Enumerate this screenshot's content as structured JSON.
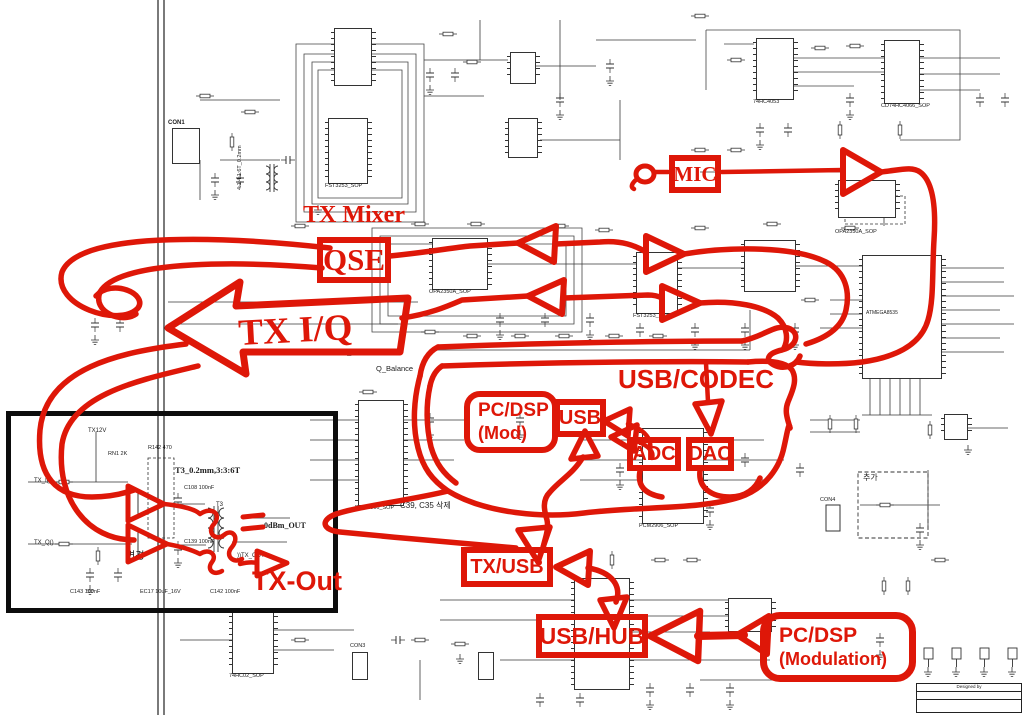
{
  "colors": {
    "annotation_red": "#de1708",
    "schematic_gray": "#333333",
    "box_black": "#0d0d0d"
  },
  "annotations": {
    "tx_mixer": "TX Mixer",
    "qse": "QSE",
    "tx_iq": "TX I/Q",
    "mic": "MIC",
    "usb_codec": "USB/CODEC",
    "pc_dsp_mod": {
      "line1": "PC/DSP",
      "line2": "(Mod)"
    },
    "usb": "USB",
    "adc": "ADC",
    "dac": "DAC",
    "tx_usb": "TX/USB",
    "usb_hub": "USB/HUB",
    "pc_dsp_modulation": {
      "line1": "PC/DSP",
      "line2": "(Modulation)"
    },
    "tx_out": "TX-Out"
  },
  "schematic": {
    "ic_labels": {
      "fst3253_top": "FST3253_SOP",
      "hc4053": "74HC4053",
      "hc4066": "CD74HC4066_SOP",
      "opa_left": "OPA2350A_SOP",
      "fst3253_mid": "FST3253_SOP",
      "opa_mic": "OPA2350A_SOP",
      "mcu": "ATMEGA8535",
      "pcm_left": "PCM2906_SOP",
      "pcm_right": "PCM2906_SOP",
      "hc02": "74HC02_SOP"
    },
    "texts": {
      "winding_note": "3:3:6T_0.2mm",
      "q_balance": "Q_Balance",
      "t3_note": "T3_0.2mm,3:3:6T",
      "dbm_out": "0dBm_OUT",
      "tx_out_net": "))TX_OUT",
      "tx12v": "TX12V",
      "tx_i": "TX_I()",
      "tx_q": "TX_Q()",
      "change_ko": "변경",
      "delete_ko": "C39, C35 삭제",
      "add_ko": "추가",
      "winding_left": "4:1:4:1:6T_0.2mm",
      "con1": "CON1",
      "con3": "CON3",
      "con4": "CON4",
      "t3": "T3",
      "rn1": "RN1 2K",
      "r142": "R142 470",
      "c108": "C108 100nF",
      "c139": "C139 100nF",
      "c143": "C143 100nF",
      "ec17": "EC17 10uF_16V",
      "c142": "C142 100nF",
      "designed_by": "Designed by"
    }
  }
}
